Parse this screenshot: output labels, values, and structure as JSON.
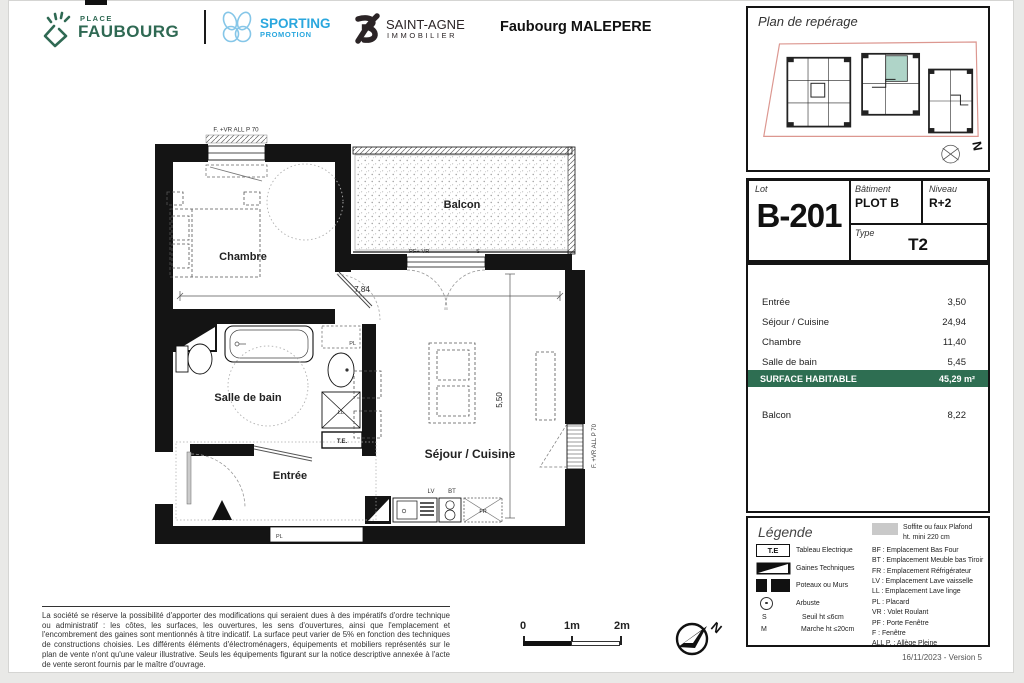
{
  "header": {
    "place": {
      "line1": "PLACE",
      "line2": "FAUBOURG"
    },
    "sporting": {
      "line1": "SPORTING",
      "line2": "PROMOTION"
    },
    "saintagne": {
      "line1": "SAINT-AGNE",
      "line2": "IMMOBILIER"
    },
    "project": "Faubourg MALEPERE"
  },
  "panel": {
    "reperage_title": "Plan de repérage",
    "north": "N",
    "lot_label": "Lot",
    "lot_value": "B-201",
    "batiment_label": "Bâtiment",
    "batiment_value": "PLOT B",
    "niveau_label": "Niveau",
    "niveau_value": "R+2",
    "type_label": "Type",
    "type_value": "T2",
    "surfaces": [
      {
        "label": "Entrée",
        "value": "3,50"
      },
      {
        "label": "Séjour / Cuisine",
        "value": "24,94"
      },
      {
        "label": "Chambre",
        "value": "11,40"
      },
      {
        "label": "Salle de bain",
        "value": "5,45"
      }
    ],
    "habitable_label": "SURFACE HABITABLE",
    "habitable_value": "45,29 m²",
    "balcon_label": "Balcon",
    "balcon_value": "8,22",
    "legend": {
      "title": "Légende",
      "te_sym": "T.E",
      "s_sym": "S",
      "m_sym": "M",
      "items_left": [
        "Tableau Electrique",
        "Gaines Techniques",
        "Poteaux ou Murs",
        "Arbuste",
        "Seuil ht ≤6cm",
        "Marche ht ≤20cm"
      ],
      "soffite1": "Soffite ou faux Plafond",
      "soffite2": "ht. mini 220 cm",
      "items_right": [
        "BF : Emplacement Bas Four",
        "BT : Emplacement Meuble bas Tiroir",
        "FR : Emplacement Réfrigérateur",
        "LV : Emplacement Lave vaisselle",
        "LL : Emplacement Lave linge",
        "PL : Placard",
        "VR : Volet Roulant",
        "PF : Porte Fenêtre",
        "F : Fenêtre",
        "ALL P. : Allège Pleine"
      ]
    },
    "version": "16/11/2023 - Version 5"
  },
  "plan": {
    "room_chambre": "Chambre",
    "room_balcon": "Balcon",
    "room_sdb": "Salle de bain",
    "room_entree": "Entrée",
    "room_sejour": "Séjour / Cuisine",
    "window_top": "F. +VR ALL P 70",
    "window_right": "F. +VR ALL P 70",
    "door_balcon": "PF+ VR",
    "seuil": "S",
    "dim_w": "7,84",
    "dim_h": "5,50",
    "lbl_lv": "LV",
    "lbl_bt": "BT",
    "lbl_fr": "FR",
    "lbl_ll": "LL",
    "lbl_te": "T.E.",
    "lbl_pl_bain": "PL",
    "lbl_pl_entree": "PL"
  },
  "footer": {
    "disclaimer": "La société se réserve la possibilité d'apporter des modifications qui seraient dues à des impératifs d'ordre technique ou administratif : les côtes, les surfaces, les ouvertures, les sens d'ouvertures, ainsi que l'emplacement et l'encombrement des gaines sont mentionnés à titre indicatif. La surface peut varier de 5% en fonction des techniques de constructions choisies. Les différents éléments d'électroménagers, équipements et mobiliers représentés sur le plan de vente n'ont qu'une valeur illustrative. Seuls les équipements figurant sur la notice descriptive annexée à l'acte de vente seront fournis par le maître d'ouvrage.",
    "scale0": "0",
    "scale1": "1m",
    "scale2": "2m",
    "north": "N"
  },
  "colors": {
    "accent_green": "#2E6E52",
    "sporting_blue": "#2AA7DE",
    "faubourg_green": "#2F6953",
    "highlight_teal": "#AFD4C8"
  }
}
